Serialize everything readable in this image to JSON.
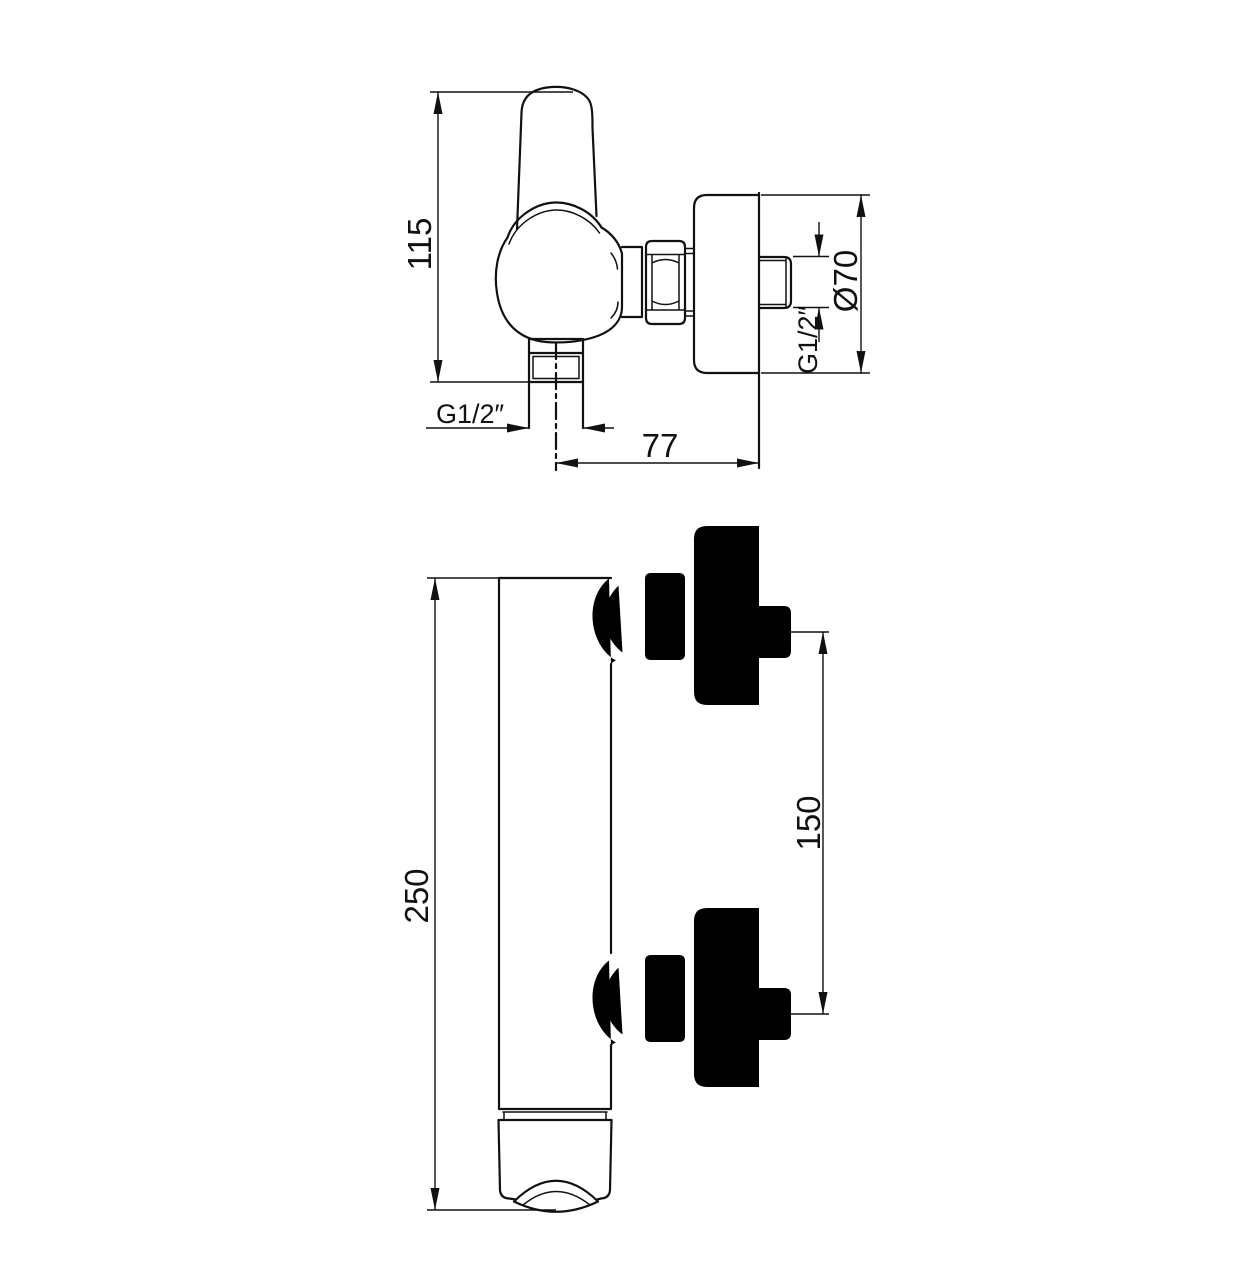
{
  "drawing": {
    "background": "#ffffff",
    "line_color": "#111111"
  },
  "side_view": {
    "dim_height": "115",
    "dim_outlet_thread": "G1/2″",
    "dim_wall_offset": "77",
    "dim_wall_thread": "G1/2″",
    "dim_flange_diameter": "Ø70"
  },
  "front_view": {
    "dim_total_height": "250",
    "dim_connection_spacing": "150"
  }
}
